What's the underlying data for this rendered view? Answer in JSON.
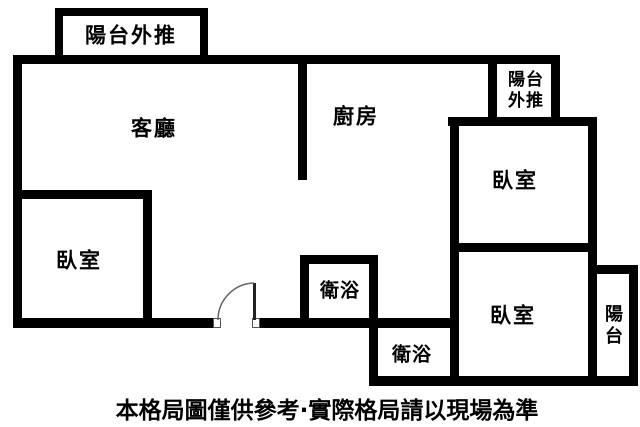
{
  "colors": {
    "wall": "#000000",
    "background": "#ffffff",
    "door_leaf": "#222222",
    "door_arc": "#666666"
  },
  "rooms": {
    "balcony_top_left": {
      "label": "陽台外推"
    },
    "living_room": {
      "label": "客廳"
    },
    "kitchen": {
      "label": "廚房"
    },
    "balcony_top_right": {
      "line1": "陽台",
      "line2": "外推"
    },
    "bedroom_top_right": {
      "label": "臥室"
    },
    "bedroom_left": {
      "label": "臥室"
    },
    "bathroom_upper": {
      "label": "衛浴"
    },
    "bathroom_lower": {
      "label": "衛浴"
    },
    "bedroom_bottom_right": {
      "label": "臥室"
    },
    "balcony_right": {
      "char1": "陽",
      "char2": "台"
    }
  },
  "disclaimer": {
    "text": "本格局圖僅供參考·實際格局請以現場為準"
  }
}
